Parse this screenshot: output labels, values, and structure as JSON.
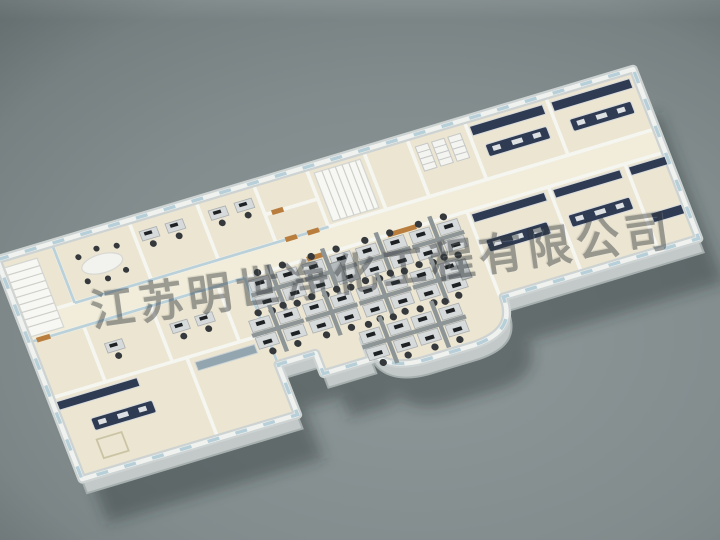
{
  "scene": {
    "description": "3D aerial cutaway rendering of a single-storey office and laboratory building floor-plan model",
    "style": "isometric dollhouse view on a gray studio backdrop with vignette"
  },
  "watermark": {
    "text": "江苏明世净化工程有限公司",
    "rotation_deg": -8,
    "color": "#343a3d",
    "opacity": 0.45
  },
  "palette": {
    "background_mid": "#8f9899",
    "background_corner": "#555d5f",
    "floor": "#ebe5d2",
    "walls": "#f6f6f1",
    "exterior_wall": "#e8ebea",
    "glass": "#b7cfd8",
    "lab_bench": "#2f3b52",
    "desk": "#d7dadb",
    "chair": "#35393c",
    "wood_door": "#b97e3e",
    "shadow": "#232c2e"
  },
  "areas": [
    {
      "name": "stairwell-west"
    },
    {
      "name": "meeting-room"
    },
    {
      "name": "back-offices"
    },
    {
      "name": "utility-rooms"
    },
    {
      "name": "stairwell-center"
    },
    {
      "name": "storage-shelves"
    },
    {
      "name": "back-laboratories"
    },
    {
      "name": "corridor"
    },
    {
      "name": "open-plan-office"
    },
    {
      "name": "curved-glass-atrium"
    },
    {
      "name": "front-laboratories"
    },
    {
      "name": "west-wing-laboratory"
    },
    {
      "name": "west-offices"
    }
  ],
  "counts": {
    "workstation_clusters": 10,
    "island_lab_benches": 5
  }
}
